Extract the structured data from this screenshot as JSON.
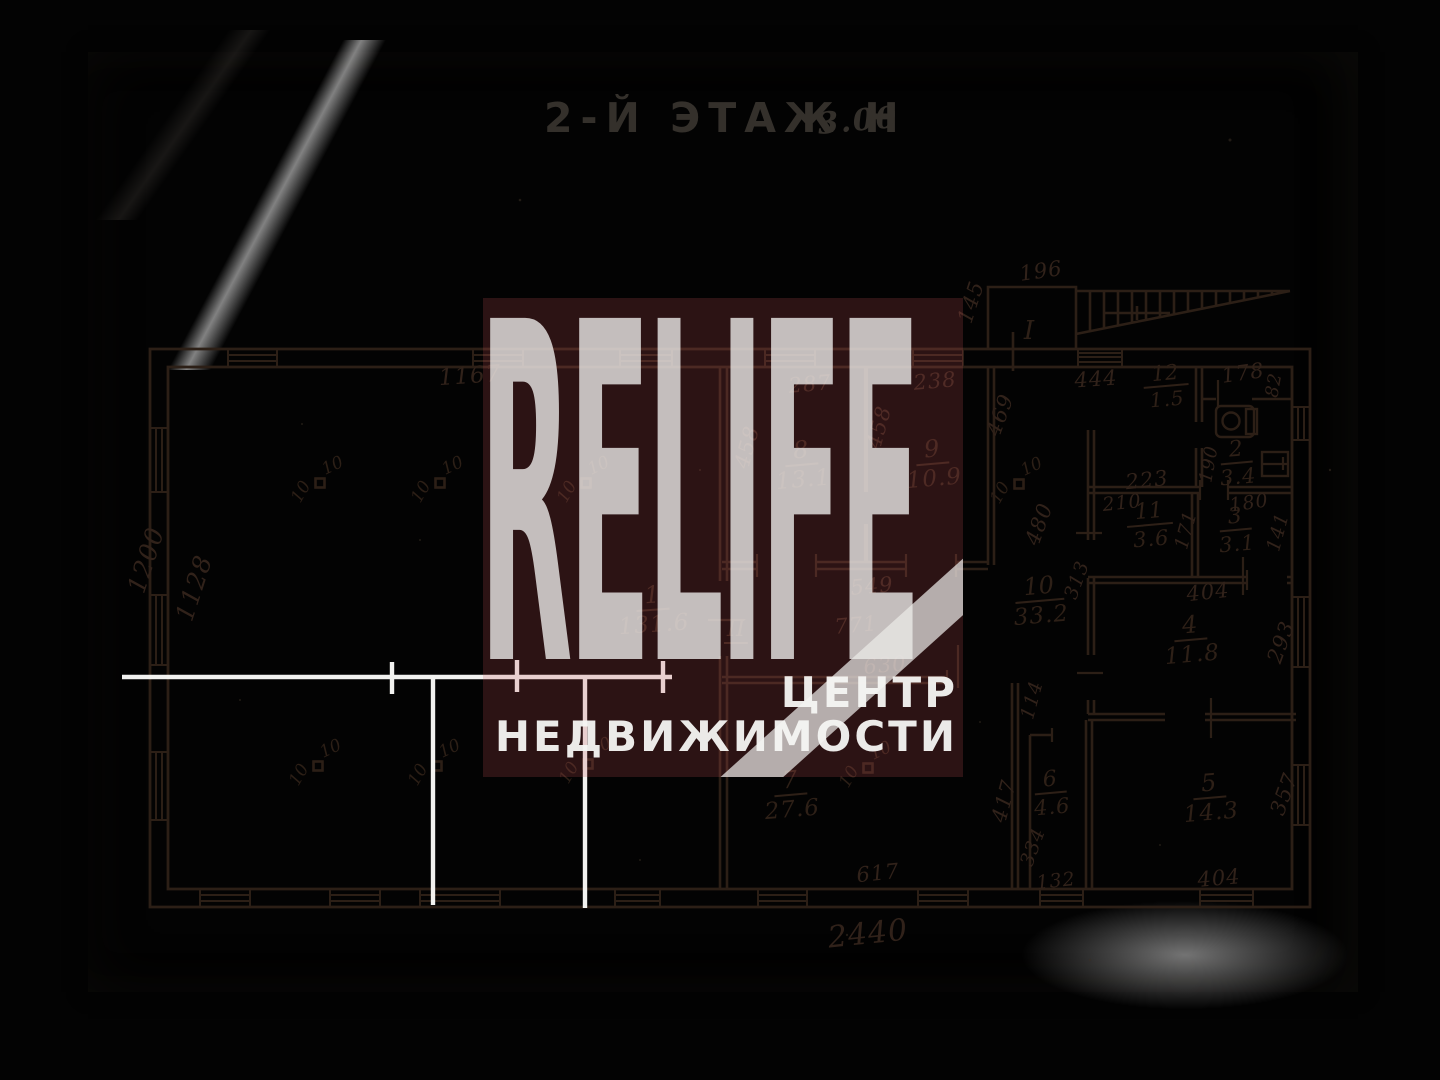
{
  "title": {
    "main": "2-Й ЭТАЖ Н",
    "scale": "3.00"
  },
  "watermark": {
    "brand": "RELIFE",
    "line1": "ЦЕНТР",
    "line2": "НЕДВИЖИМОСТИ"
  },
  "rooms": {
    "1": {
      "num": "1",
      "area": "131.6"
    },
    "2": {
      "num": "2",
      "area": "3.4"
    },
    "3": {
      "num": "3",
      "area": "3.1"
    },
    "4": {
      "num": "4",
      "area": "11.8"
    },
    "5": {
      "num": "5",
      "area": "14.3"
    },
    "6": {
      "num": "6",
      "area": "4.6"
    },
    "7": {
      "num": "7",
      "area": "27.6"
    },
    "8": {
      "num": "8",
      "area": "13.1"
    },
    "9": {
      "num": "9",
      "area": "10.9"
    },
    "10": {
      "num": "10",
      "area": "33.2"
    },
    "11": {
      "num": "11",
      "area": "3.6"
    },
    "12": {
      "num": "12",
      "area": "1.5"
    }
  },
  "dims": {
    "outer_bottom": "2440",
    "outer_left": "1200",
    "inner_left": "1128",
    "hall_top": "1167",
    "r8_top": "287",
    "r9_top": "238",
    "r8_left": "458",
    "r8_mid": "458",
    "r9_right": "469",
    "r89_bottom": "549",
    "corridor": "771",
    "r7_top": "630",
    "r7_bottom": "617",
    "r7_right": "417",
    "passage": "114",
    "r6_left": "334",
    "r6_bottom": "132",
    "r10_top": "444",
    "r10_mid": "480",
    "r10_low": "313",
    "r11_outer": "223",
    "r11_top": "210",
    "r11_right": "171",
    "r3_top": "180",
    "r3_right": "141",
    "r2_left": "190",
    "lobby_top": "178",
    "lobby_right": "82",
    "r4_top": "404",
    "r4_right": "293",
    "r5_bottom": "404",
    "r5_right": "357",
    "stair_top": "196",
    "stair_left": "145"
  },
  "landmarks": {
    "stair": "I",
    "hall": "II"
  },
  "columns": {
    "size": "10"
  },
  "colors": {
    "ink": "#2c1f16",
    "paper": "#e9e8e6",
    "watermark_pink": "#c54e54",
    "marker_white": "#fcfcfa"
  }
}
